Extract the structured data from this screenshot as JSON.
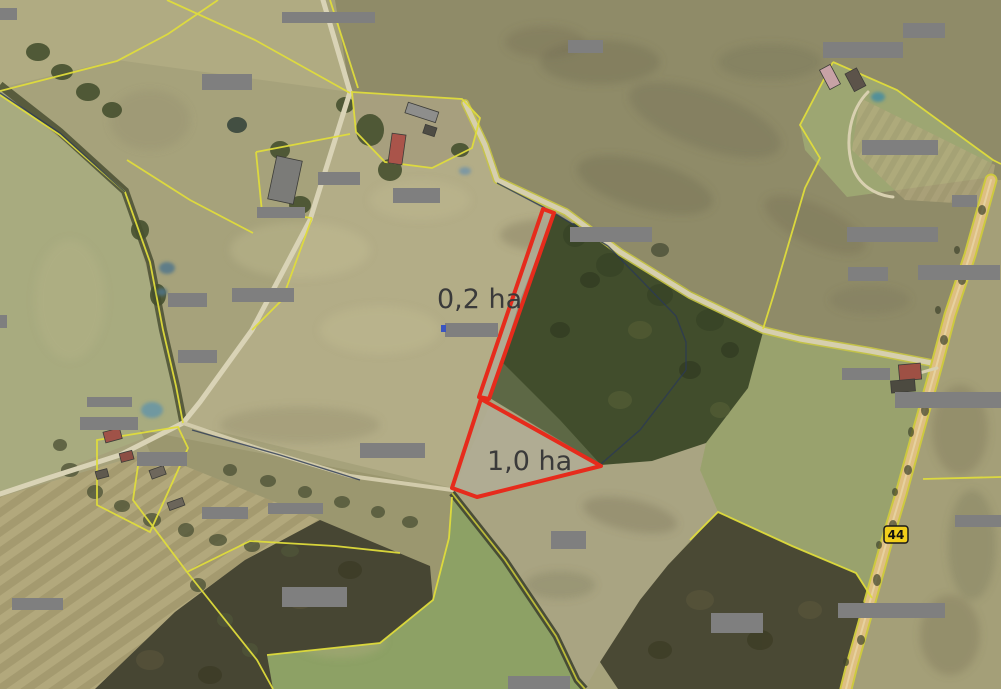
{
  "map": {
    "type": "aerial-cadastral-view",
    "area_labels": [
      {
        "text": "0,2 ha"
      },
      {
        "text": "1,0 ha"
      }
    ],
    "road_badge": {
      "text": "44"
    },
    "parcels": [
      {
        "name": "parcel-0-2-ha",
        "label": "0,2 ha",
        "points": "543,209 554,213 489,399 479,397",
        "fill": "rgba(178,173,155,0.75)"
      },
      {
        "name": "parcel-1-0-ha",
        "label": "1,0 ha",
        "points": "481,399 601,466 477,497 452,488",
        "fill": "rgba(182,178,162,0.55)"
      }
    ],
    "colors": {
      "parcel_outline": "#e62b1c",
      "boundary_line": "#e0dd3c",
      "redaction": "#7f7f7f",
      "road_badge_bg": "#f1ce1a",
      "label_text": "#3a3a3a"
    },
    "redaction_boxes": [
      [
        0,
        8,
        17,
        12
      ],
      [
        282,
        12,
        93,
        11
      ],
      [
        568,
        40,
        35,
        13
      ],
      [
        823,
        42,
        80,
        16
      ],
      [
        903,
        23,
        42,
        15
      ],
      [
        202,
        74,
        50,
        16
      ],
      [
        318,
        172,
        42,
        13
      ],
      [
        393,
        188,
        47,
        15
      ],
      [
        257,
        207,
        48,
        11
      ],
      [
        570,
        227,
        82,
        15
      ],
      [
        862,
        140,
        76,
        15
      ],
      [
        847,
        227,
        91,
        15
      ],
      [
        952,
        195,
        25,
        12
      ],
      [
        848,
        267,
        40,
        14
      ],
      [
        918,
        265,
        82,
        15
      ],
      [
        168,
        293,
        39,
        14
      ],
      [
        232,
        288,
        62,
        14
      ],
      [
        178,
        350,
        39,
        13
      ],
      [
        445,
        323,
        53,
        14
      ],
      [
        842,
        368,
        48,
        12
      ],
      [
        895,
        392,
        106,
        16
      ],
      [
        87,
        397,
        45,
        10
      ],
      [
        80,
        417,
        58,
        13
      ],
      [
        137,
        452,
        50,
        14
      ],
      [
        360,
        443,
        65,
        15
      ],
      [
        551,
        531,
        35,
        18
      ],
      [
        202,
        507,
        46,
        12
      ],
      [
        268,
        503,
        55,
        11
      ],
      [
        12,
        598,
        51,
        12
      ],
      [
        282,
        587,
        65,
        20
      ],
      [
        711,
        613,
        52,
        20
      ],
      [
        838,
        603,
        107,
        15
      ],
      [
        955,
        515,
        46,
        12
      ],
      [
        508,
        676,
        62,
        13
      ],
      [
        0,
        315,
        7,
        13
      ]
    ]
  }
}
